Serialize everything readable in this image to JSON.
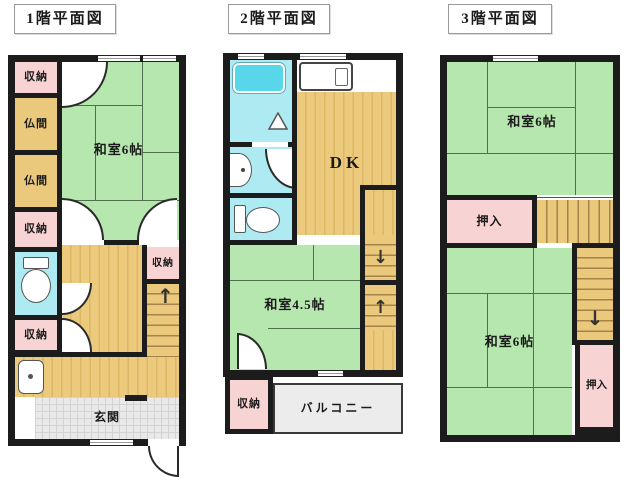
{
  "labels": {
    "floor1": "1階平面図",
    "floor2": "2階平面図",
    "floor3": "3階平面図"
  },
  "colors": {
    "wall": "#1c1c1c",
    "tatami_green": "#b6e7ae",
    "closet_pink": "#f8d3d3",
    "wood_tan": "#eac97d",
    "bath_cyan": "#aeeaf2",
    "bathtub_cyan": "#57d7e9",
    "entry_gray": "#e9e9e9",
    "balcony_gray": "#ececec"
  },
  "floor1": {
    "rooms": {
      "closet1": "収納",
      "butsuma1": "仏間",
      "butsuma2": "仏間",
      "closet2": "収納",
      "closet3": "収納",
      "washitsu6": "和室6帖",
      "closet_right": "収納",
      "genkan": "玄関"
    },
    "stairs_up_arrow": "↑"
  },
  "floor2": {
    "rooms": {
      "dk": "DK",
      "washitsu45": "和室4.5帖",
      "closet": "収納",
      "balcony": "バルコニー"
    },
    "stairs_down_arrow": "↓",
    "stairs_up_arrow": "↑"
  },
  "floor3": {
    "rooms": {
      "washitsu6_top": "和室6帖",
      "oshiire_top": "押入",
      "washitsu6_bottom": "和室6帖",
      "oshiire_bottom": "押入"
    },
    "stairs_down_arrow": "↓"
  }
}
